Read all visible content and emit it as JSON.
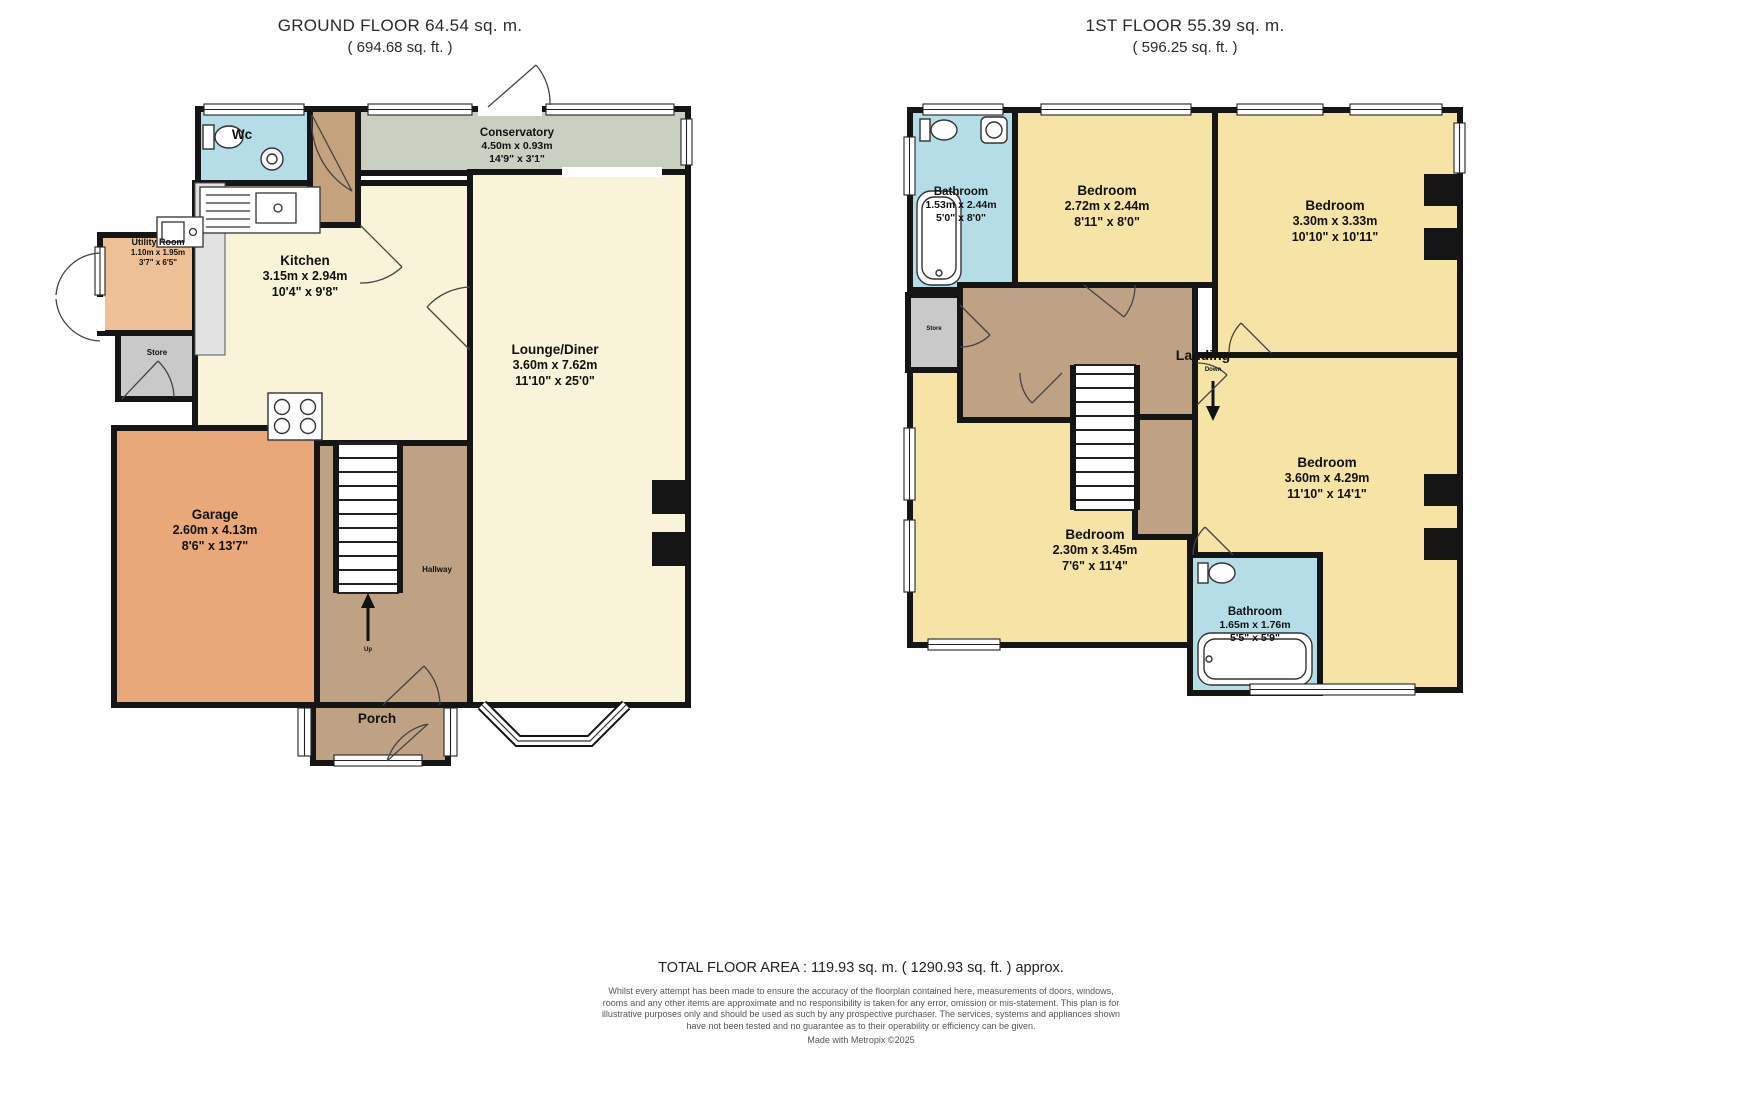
{
  "ground_floor": {
    "title": "GROUND FLOOR 64.54 sq. m.",
    "subtitle": "( 694.68 sq. ft. )",
    "rooms": {
      "wc": {
        "name": "Wc"
      },
      "conservatory": {
        "name": "Conservatory",
        "metric": "4.50m x 0.93m",
        "imperial": "14'9\" x 3'1\""
      },
      "kitchen": {
        "name": "Kitchen",
        "metric": "3.15m x 2.94m",
        "imperial": "10'4\" x 9'8\""
      },
      "utility": {
        "name": "Utility Room",
        "metric": "1.10m x 1.95m",
        "imperial": "3'7\" x 6'5\""
      },
      "store": {
        "name": "Store"
      },
      "garage": {
        "name": "Garage",
        "metric": "2.60m x 4.13m",
        "imperial": "8'6\" x 13'7\""
      },
      "lounge": {
        "name": "Lounge/Diner",
        "metric": "3.60m x 7.62m",
        "imperial": "11'10\" x 25'0\""
      },
      "hallway": {
        "name": "Hallway"
      },
      "porch": {
        "name": "Porch"
      },
      "up": {
        "name": "Up"
      }
    }
  },
  "first_floor": {
    "title": "1ST FLOOR 55.39 sq. m.",
    "subtitle": "( 596.25 sq. ft. )",
    "rooms": {
      "bathroom1": {
        "name": "Bathroom",
        "metric": "1.53m x 2.44m",
        "imperial": "5'0\" x 8'0\""
      },
      "bedroom1": {
        "name": "Bedroom",
        "metric": "2.72m x 2.44m",
        "imperial": "8'11\" x 8'0\""
      },
      "bedroom2": {
        "name": "Bedroom",
        "metric": "3.30m x 3.33m",
        "imperial": "10'10\" x 10'11\""
      },
      "landing": {
        "name": "Landing"
      },
      "store": {
        "name": "Store"
      },
      "down": {
        "name": "Down"
      },
      "bedroom3": {
        "name": "Bedroom",
        "metric": "2.30m x 3.45m",
        "imperial": "7'6\" x 11'4\""
      },
      "bathroom2": {
        "name": "Bathroom",
        "metric": "1.65m x 1.76m",
        "imperial": "5'5\" x 5'9\""
      },
      "bedroom4": {
        "name": "Bedroom",
        "metric": "3.60m x 4.29m",
        "imperial": "11'10\" x 14'1\""
      }
    }
  },
  "footer": {
    "total": "TOTAL FLOOR AREA : 119.93 sq. m. ( 1290.93 sq. ft. ) approx.",
    "disclaimer": "Whilst every attempt has been made to ensure the accuracy of the floorplan contained here, measurements of doors, windows, rooms and any other items are approximate and no responsibility is taken for any error, omission or mis-statement. This plan is for illustrative purposes only and should be used as such by any prospective purchaser. The services, systems and appliances shown have not been tested and no guarantee as to their operability or efficiency can be given.",
    "credit": "Made with Metropix ©2025"
  },
  "colors": {
    "wall": "#151515",
    "bedroom": "#f6e4a6",
    "bathroom": "#b5dde8",
    "hall": "#bfa183",
    "closet": "#c3a27d",
    "garage": "#e8a87a",
    "utility": "#edc096",
    "store": "#c9c9c9",
    "conservatory": "#c9cfc1",
    "lounge": "#f9f3da",
    "counter": "#e2e2e2"
  }
}
